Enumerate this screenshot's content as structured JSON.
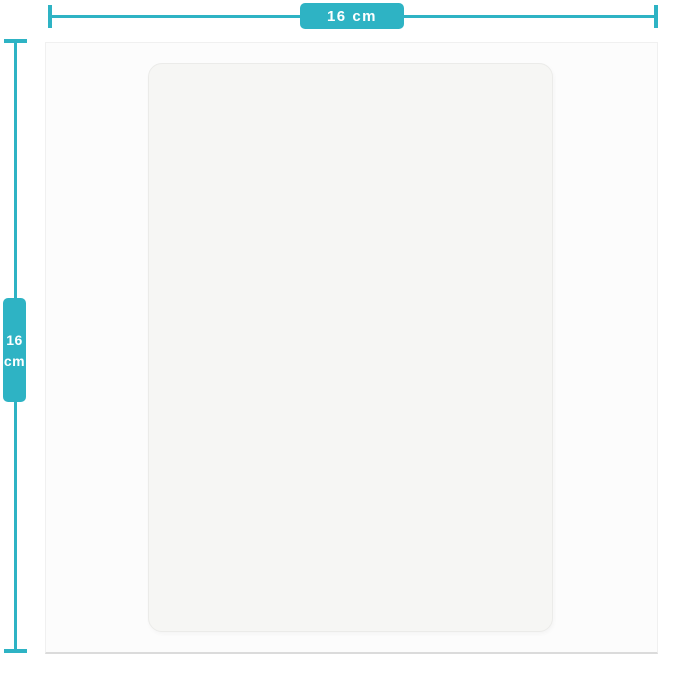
{
  "colors": {
    "accent": "#2eb3c4",
    "page_bg": "#ffffff",
    "photo_bg": "#fcfcfc",
    "photo_border": "#f0f0f0",
    "photo_border_bottom": "#dbdbdb",
    "sheet_bg": "#f6f6f4",
    "sheet_border": "#ebebe9",
    "label_text": "#ffffff"
  },
  "dimensions": {
    "width": {
      "label": "16 cm"
    },
    "height": {
      "line1": "16",
      "line2": "cm"
    }
  }
}
